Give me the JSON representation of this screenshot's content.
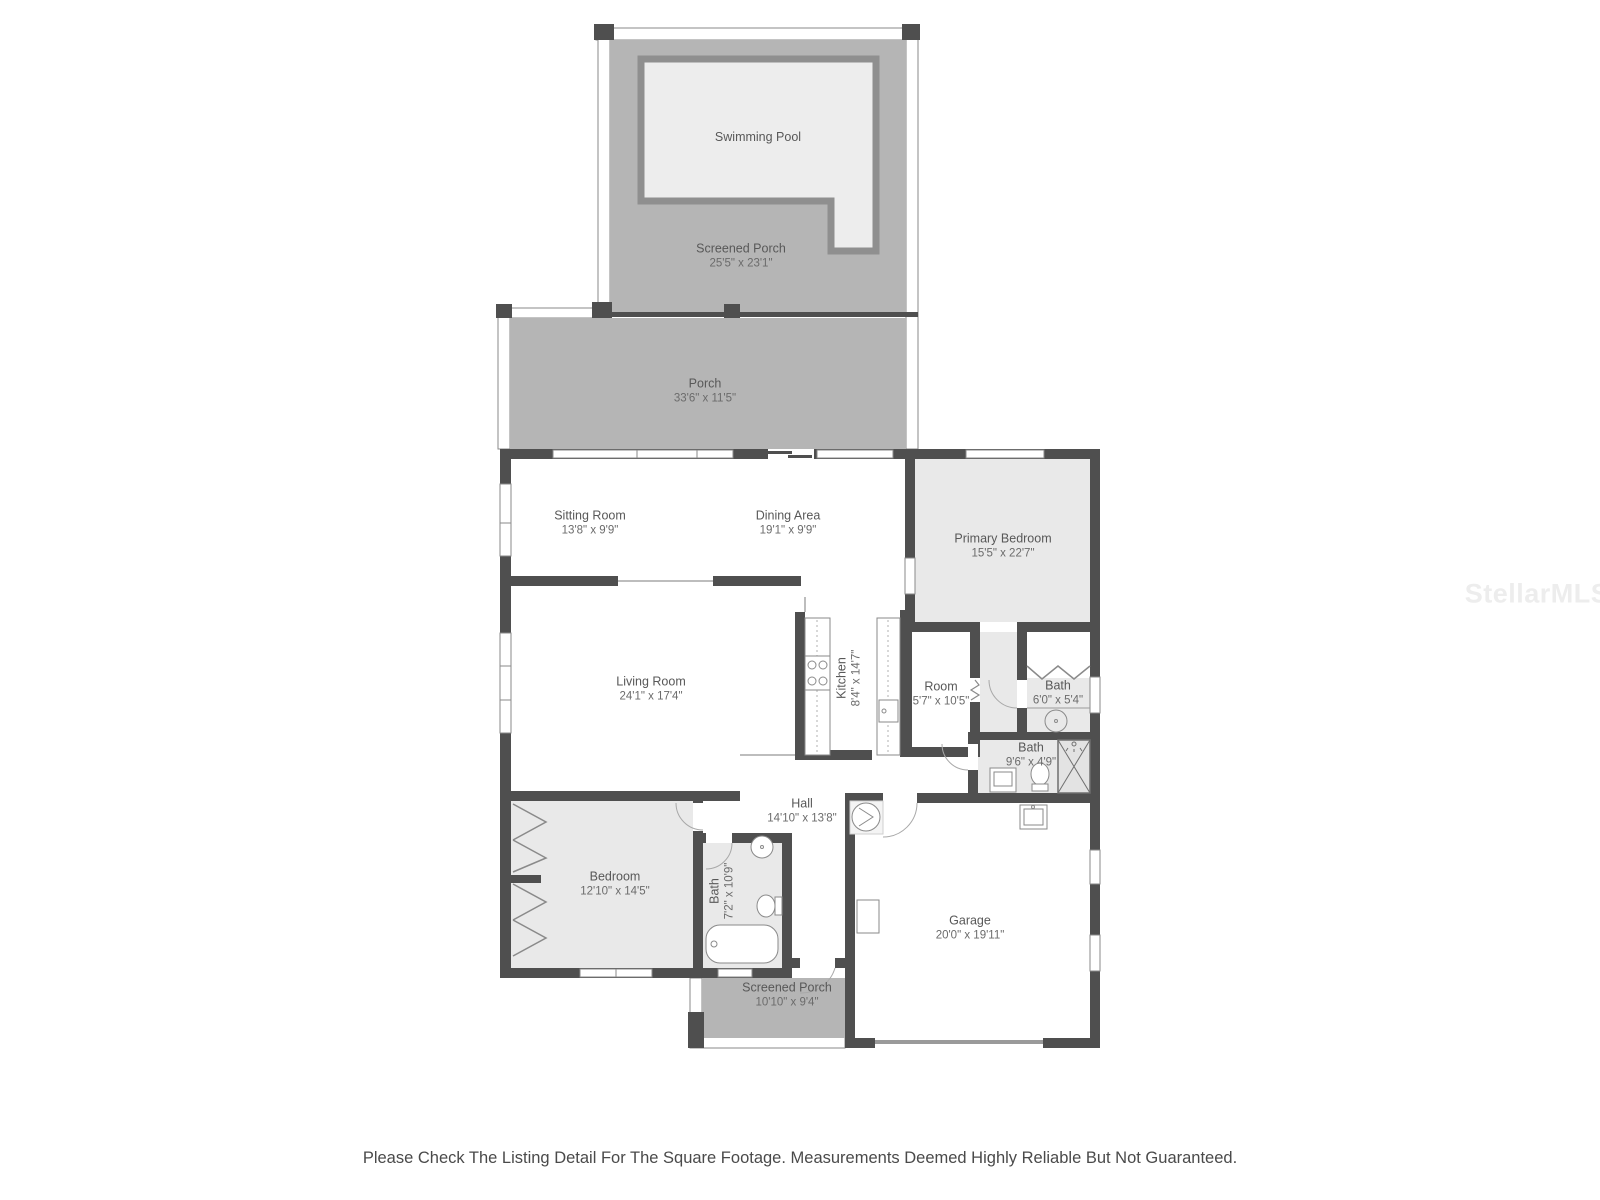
{
  "floorplan": {
    "rooms": [
      {
        "id": "swimming-pool",
        "name": "Swimming Pool"
      },
      {
        "id": "screened-porch-top",
        "name": "Screened Porch",
        "dims": "25'5\" x 23'1\""
      },
      {
        "id": "porch",
        "name": "Porch",
        "dims": "33'6\" x 11'5\""
      },
      {
        "id": "sitting-room",
        "name": "Sitting Room",
        "dims": "13'8\" x 9'9\""
      },
      {
        "id": "dining-area",
        "name": "Dining Area",
        "dims": "19'1\" x 9'9\""
      },
      {
        "id": "primary-bedroom",
        "name": "Primary Bedroom",
        "dims": "15'5\" x 22'7\""
      },
      {
        "id": "living-room",
        "name": "Living Room",
        "dims": "24'1\" x 17'4\""
      },
      {
        "id": "kitchen",
        "name": "Kitchen",
        "dims": "8'4\" x 14'7\""
      },
      {
        "id": "room",
        "name": "Room",
        "dims": "5'7\" x 10'5\""
      },
      {
        "id": "bath-primary",
        "name": "Bath",
        "dims": "6'0\" x 5'4\""
      },
      {
        "id": "bath-hall",
        "name": "Bath",
        "dims": "9'6\" x 4'9\""
      },
      {
        "id": "hall",
        "name": "Hall",
        "dims": "14'10\" x 13'8\""
      },
      {
        "id": "bedroom",
        "name": "Bedroom",
        "dims": "12'10\" x 14'5\""
      },
      {
        "id": "bath-guest",
        "name": "Bath",
        "dims": "7'2\" x 10'9\""
      },
      {
        "id": "screened-porch-bottom",
        "name": "Screened Porch",
        "dims": "10'10\" x 9'4\""
      },
      {
        "id": "garage",
        "name": "Garage",
        "dims": "20'0\" x 19'11\""
      }
    ],
    "colors": {
      "wall": "#4f4f4f",
      "porch_fill": "#b5b5b5",
      "room_fill": "#e9e9e9",
      "pool_fill": "#ededed",
      "pool_edge": "#8f8f8f"
    },
    "watermark": "StellarMLS",
    "disclaimer": "Please Check The Listing Detail For The Square Footage. Measurements Deemed Highly Reliable But Not Guaranteed."
  }
}
